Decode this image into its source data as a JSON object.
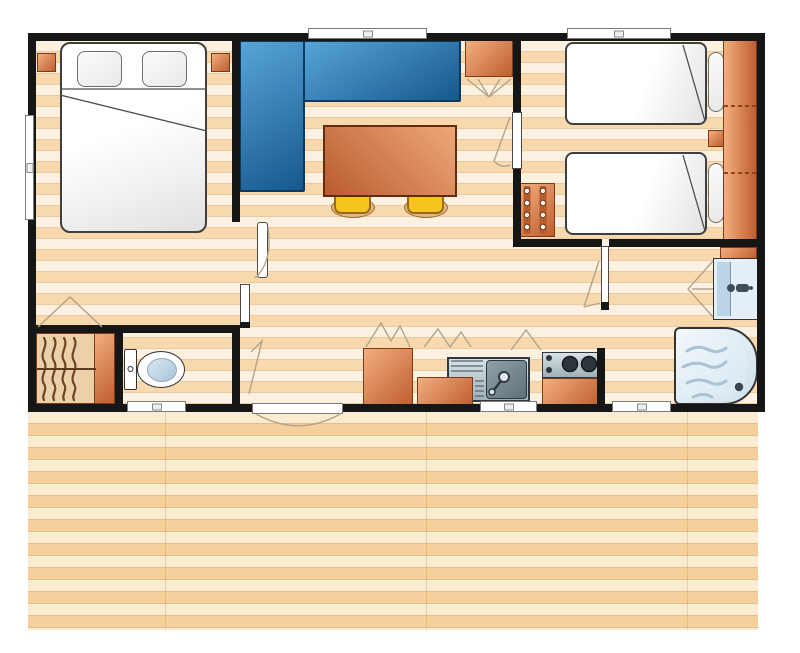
{
  "plan": {
    "type": "mobile-home-floor-plan",
    "rooms": {
      "master_bedroom": "Master bedroom",
      "living_dining": "Living and dining area",
      "twin_bedroom": "Twin bedroom",
      "closet": "Hanging closet",
      "wc": "WC",
      "kitchen": "Kitchen",
      "shower_room": "Shower room",
      "terrace": "Wooden terrace deck"
    },
    "furniture": {
      "double_bed": "Double bed",
      "pillow": "Pillow",
      "nightstand": "Nightstand",
      "corner_sofa": "Corner sofa",
      "dining_table": "Dining table",
      "stool": "Stool",
      "storage_cabinet": "Storage cabinet",
      "single_bed": "Single bed",
      "wardrobe": "Wardrobe",
      "drawer_unit": "Drawer unit",
      "hanging_rail": "Hanging rail with clothes",
      "toilet": "Toilet",
      "fridge": "Fridge",
      "kitchen_counter": "Kitchen counter",
      "sink": "Sink with drainer",
      "hob": "Hob with burners",
      "washbasin": "Washbasin",
      "shower_tray": "Shower tray",
      "window": "Window",
      "door": "Door"
    },
    "colors": {
      "wall": "#161616",
      "floor_base": "#f9e0bb",
      "deck_base": "#f6d7a7",
      "sofa_blue_light": "#57a4d8",
      "sofa_blue_dark": "#16588e",
      "sofa_border": "#0c3a5f",
      "orange_light": "#f2ae80",
      "orange_dark": "#bf5e2e",
      "orange_border": "#7c3a16",
      "table_light": "#efa878",
      "table_dark": "#b95c30",
      "table_border": "#5f2d10",
      "stool_yellow": "#f6c41c",
      "stool_border": "#9a6a1a",
      "steel_light": "#d8e2e6",
      "steel_dark": "#9fb0b6",
      "bath_fill": "#e4eff7",
      "bath_accent": "#bcd4e6",
      "swing_line": "#b3a38a",
      "bed_border": "#3f3f3f"
    }
  }
}
